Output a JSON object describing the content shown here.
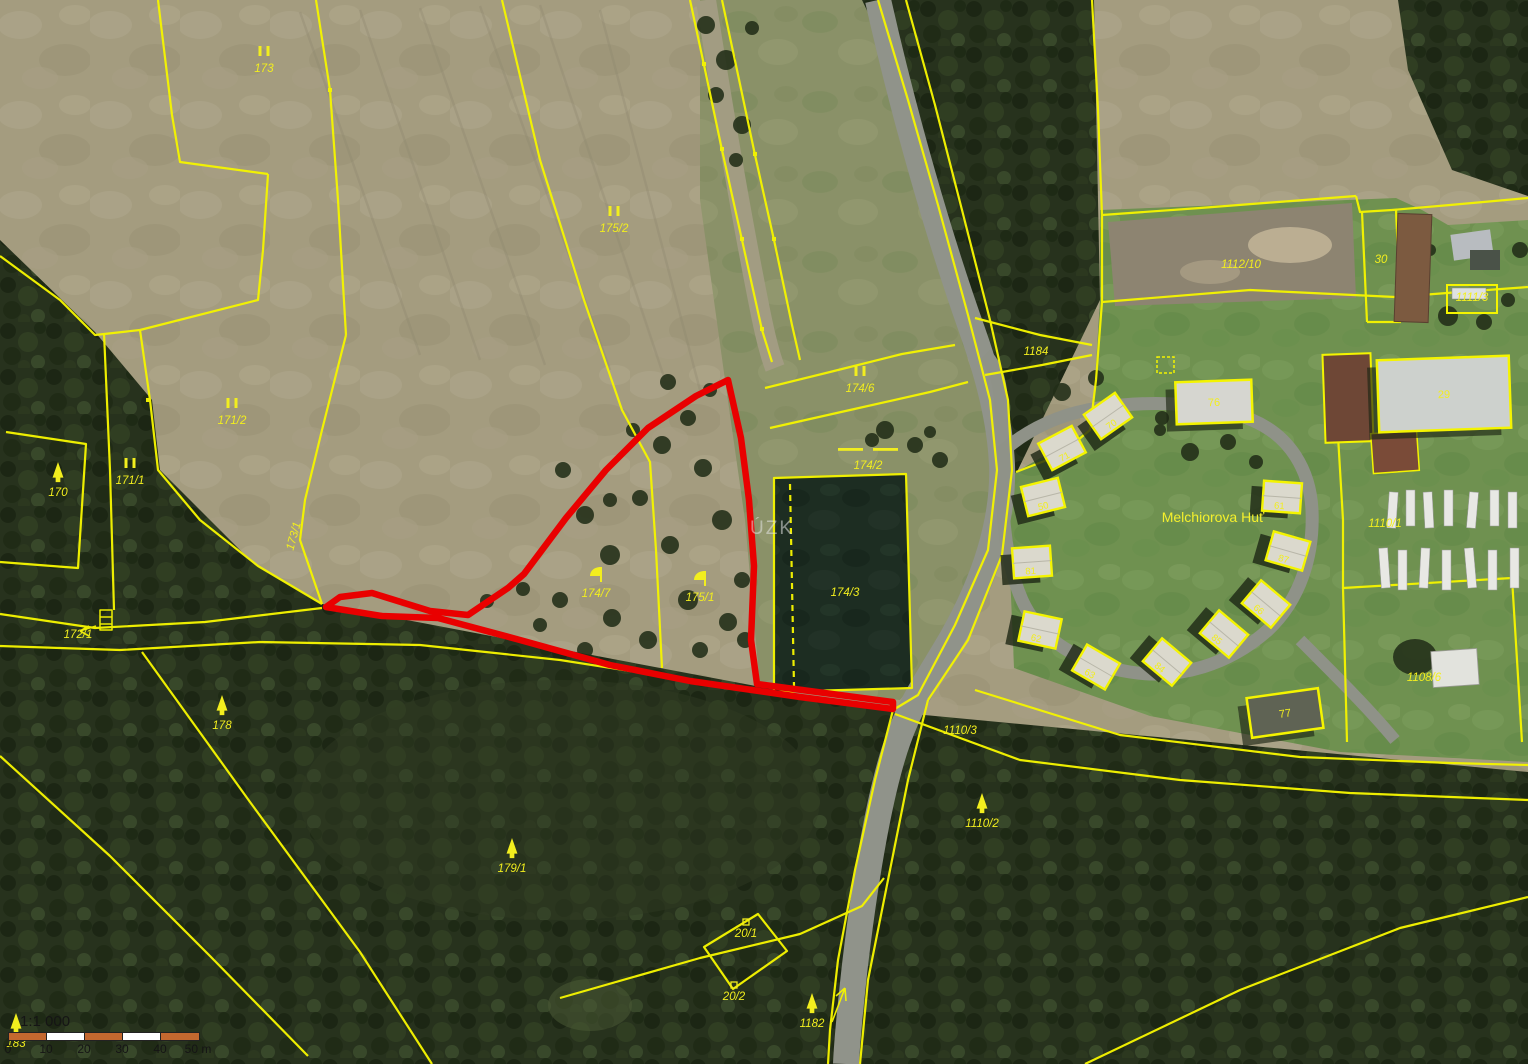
{
  "map": {
    "place_label": "Melchiorova Huť",
    "watermark": "ÚZK",
    "colors": {
      "boundary": "#f4f400",
      "highlight": "#e90000",
      "label": "#f2ee1e",
      "water": "#1d2d22",
      "forest": "#27321d",
      "field": "#a49c7f",
      "grass": "#6f9150",
      "road": "#90938a"
    },
    "scale_bar": {
      "ratio": "1:1 000",
      "segment_colors": [
        "#c4682f",
        "#ffffff",
        "#c4682f",
        "#ffffff",
        "#c4682f"
      ],
      "ticks": [
        "0",
        "10",
        "20",
        "30",
        "40",
        "50 m"
      ]
    },
    "parcel_labels": [
      {
        "text": "173",
        "x": 264,
        "y": 72,
        "sym": "II"
      },
      {
        "text": "175/2",
        "x": 614,
        "y": 232,
        "sym": "II"
      },
      {
        "text": "171/2",
        "x": 232,
        "y": 424,
        "sym": "II"
      },
      {
        "text": "171/1",
        "x": 130,
        "y": 484,
        "sym": "II"
      },
      {
        "text": "170",
        "x": 58,
        "y": 496,
        "sym": "tree"
      },
      {
        "text": "173/1",
        "x": 297,
        "y": 537,
        "rot": -75
      },
      {
        "text": "172/1",
        "x": 78,
        "y": 638
      },
      {
        "text": "178",
        "x": 222,
        "y": 729,
        "sym": "tree"
      },
      {
        "text": "179/1",
        "x": 512,
        "y": 872,
        "sym": "tree"
      },
      {
        "text": "20/1",
        "x": 746,
        "y": 937,
        "sym": "sq"
      },
      {
        "text": "20/2",
        "x": 734,
        "y": 1000,
        "sym": "sq"
      },
      {
        "text": "1182",
        "x": 812,
        "y": 1027,
        "sym": "tree"
      },
      {
        "text": "183",
        "x": 16,
        "y": 1047,
        "sym": "tree"
      },
      {
        "text": "174/6",
        "x": 860,
        "y": 392,
        "sym": "II"
      },
      {
        "text": "174/2",
        "x": 868,
        "y": 469,
        "sym": "dashes"
      },
      {
        "text": "174/3",
        "x": 845,
        "y": 596
      },
      {
        "text": "174/7",
        "x": 596,
        "y": 597,
        "sym": "flag"
      },
      {
        "text": "175/1",
        "x": 700,
        "y": 601,
        "sym": "flag"
      },
      {
        "text": "1184",
        "x": 1036,
        "y": 355
      },
      {
        "text": "1110/3",
        "x": 960,
        "y": 734
      },
      {
        "text": "1110/2",
        "x": 982,
        "y": 827,
        "sym": "tree"
      },
      {
        "text": "1112/10",
        "x": 1241,
        "y": 268
      },
      {
        "text": "30",
        "x": 1381,
        "y": 263
      },
      {
        "text": "1111/3",
        "x": 1472,
        "y": 301
      },
      {
        "text": "1110/1",
        "x": 1385,
        "y": 527
      },
      {
        "text": "1108/6",
        "x": 1424,
        "y": 681
      }
    ],
    "cabins": [
      {
        "label": "70",
        "cx": 1108,
        "cy": 416,
        "rot": -35
      },
      {
        "label": "71",
        "cx": 1062,
        "cy": 448,
        "rot": -28
      },
      {
        "label": "50",
        "cx": 1043,
        "cy": 497,
        "rot": -14
      },
      {
        "label": "81",
        "cx": 1032,
        "cy": 562,
        "rot": -4
      },
      {
        "label": "62",
        "cx": 1040,
        "cy": 630,
        "rot": 12
      },
      {
        "label": "63",
        "cx": 1096,
        "cy": 667,
        "rot": 30
      },
      {
        "label": "84",
        "cx": 1167,
        "cy": 662,
        "rot": 40
      },
      {
        "label": "85",
        "cx": 1224,
        "cy": 634,
        "rot": 40
      },
      {
        "label": "66",
        "cx": 1266,
        "cy": 604,
        "rot": 40
      },
      {
        "label": "87",
        "cx": 1288,
        "cy": 551,
        "rot": 16
      },
      {
        "label": "61",
        "cx": 1282,
        "cy": 497,
        "rot": 4
      }
    ],
    "buildings": [
      {
        "label": "76",
        "cx": 1214,
        "cy": 402,
        "w": 76,
        "h": 42,
        "rot": -2,
        "fill": "#d6d6d0"
      },
      {
        "label": "29",
        "cx": 1444,
        "cy": 394,
        "w": 132,
        "h": 72,
        "rot": -2,
        "fill": "#cdd1cd"
      },
      {
        "label": "77",
        "cx": 1285,
        "cy": 713,
        "w": 72,
        "h": 40,
        "rot": -8,
        "fill": "#5f6354"
      }
    ]
  }
}
